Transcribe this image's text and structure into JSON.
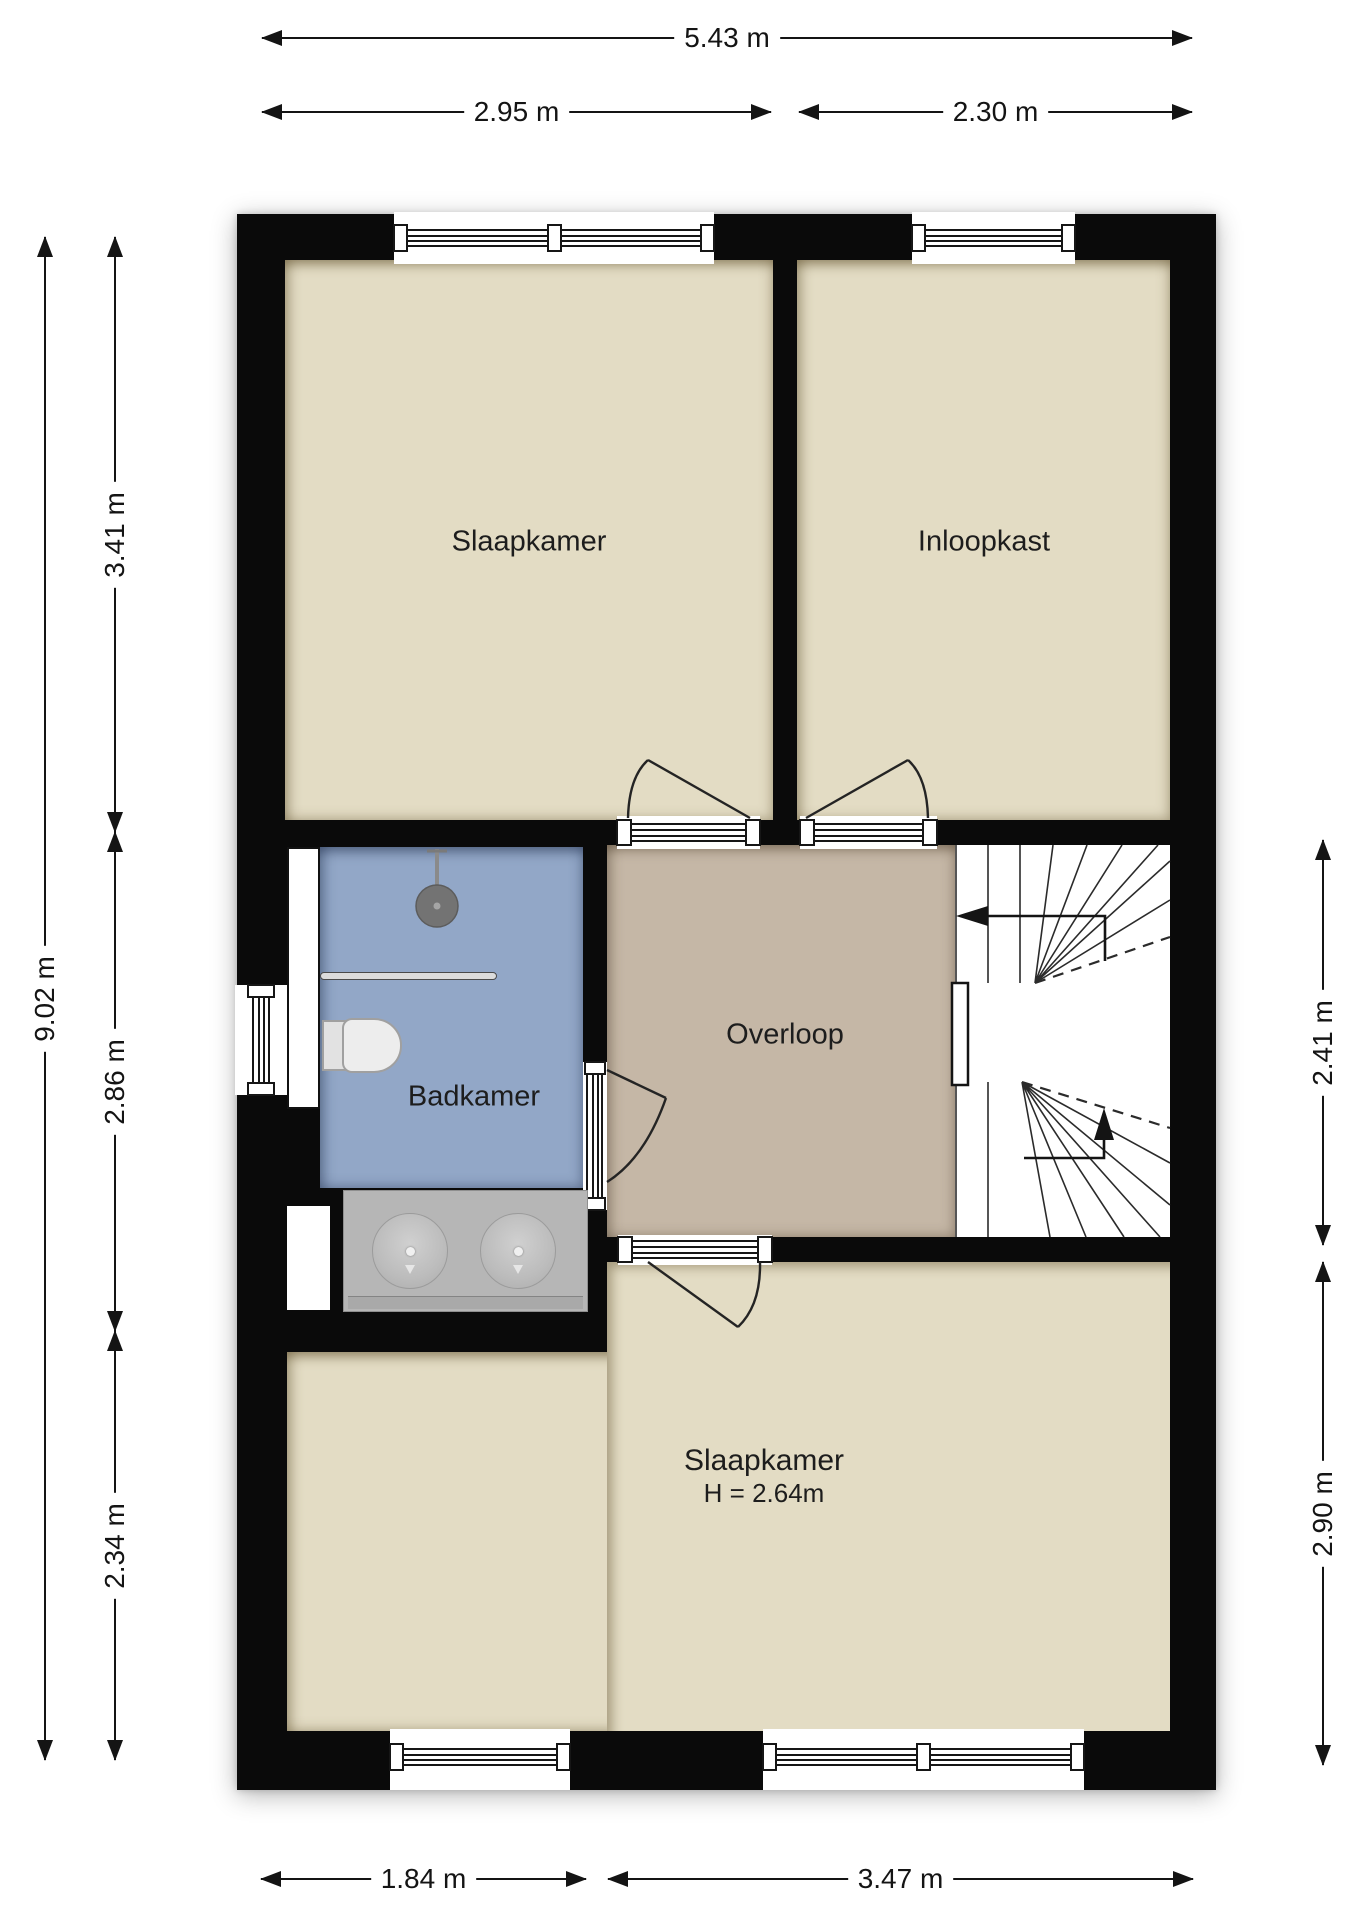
{
  "rooms": {
    "bedroom_top": {
      "label": "Slaapkamer"
    },
    "closet": {
      "label": "Inloopkast"
    },
    "bathroom": {
      "label": "Badkamer"
    },
    "landing": {
      "label": "Overloop"
    },
    "bedroom_bottom": {
      "label": "Slaapkamer",
      "ceiling_height": "H = 2.64m"
    }
  },
  "dimensions": {
    "top_total": "5.43 m",
    "top_left": "2.95 m",
    "top_right": "2.30 m",
    "left_total": "9.02 m",
    "left_top": "3.41 m",
    "left_middle": "2.86 m",
    "left_bottom": "2.34 m",
    "right_middle": "2.41 m",
    "right_bottom": "2.90 m",
    "bottom_left": "1.84 m",
    "bottom_right": "3.47 m"
  },
  "colors": {
    "wall": "#0a0a0a",
    "floor_beige": "#e3dcc4",
    "floor_bathroom": "#92a7c7",
    "floor_landing": "#c5b7a6",
    "fixture_gray": "#b6b6b6",
    "dimension_text": "#141414"
  },
  "fixtures": {
    "shower": "shower-head-icon",
    "shower_screen": "shower-screen-icon",
    "toilet": "toilet-icon",
    "vanity": "double-sink-vanity-icon",
    "staircase": "winder-staircase-icon",
    "stair_direction_arrows": "stair-arrow-icon"
  }
}
